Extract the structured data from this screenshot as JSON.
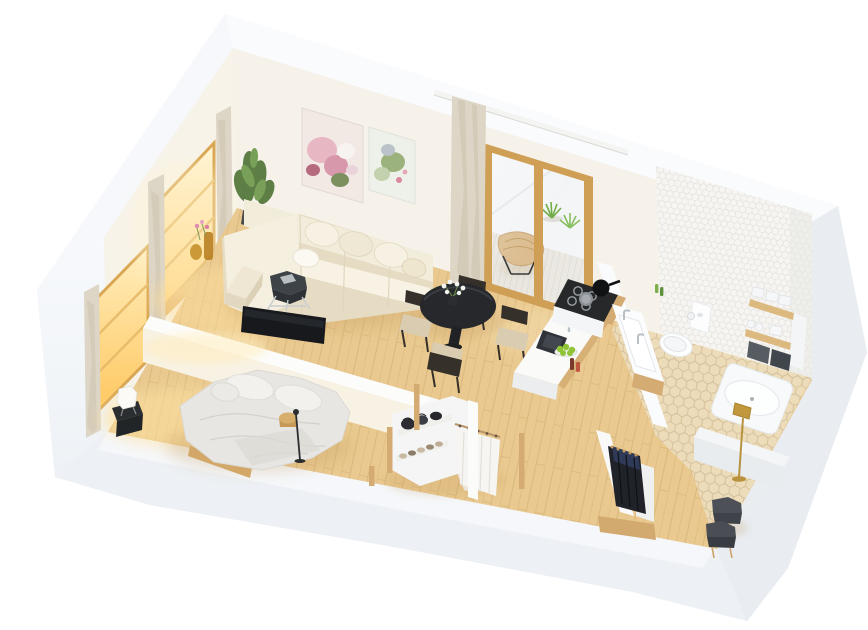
{
  "meta": {
    "kind": "isometric-3d-floorplan-render",
    "text_visible": false
  },
  "palette": {
    "bg": "#ffffff",
    "band_top": "#fafbfd",
    "band_left": "#f6f8fb",
    "band_right": "#e9edf2",
    "band_bottom": "#edf0f4",
    "band_bottom_top_face": "#f5f7fa",
    "wall_inner_warm": "#f7f3e9",
    "wall_inner_right": "#eaedf0",
    "left_outer_face": "#f3f6f9",
    "floor_wood": "#e9c98f",
    "floor_glow": "#ffdf9e",
    "hex_floor": "#ecdcba",
    "hex_floor_line": "#c9b188",
    "hex_wall": "#f6f5f2",
    "deck": "#e8e5de",
    "door_wood": "#cf9f56",
    "window_frame": "#dfae5c",
    "sill_wood": "#dfb26a",
    "curtain": "#ddd5c5",
    "sofa_cream": "#f2ecdb",
    "sofa_light": "#f7f2e4",
    "sofa_shadow": "#e6dcc4",
    "pouf": "#efe7d3",
    "plant_green": "#5d7f46",
    "plant_light": "#78a058",
    "grass_green": "#69a83c",
    "graphite": "#3e4347",
    "tv_black": "#17191c",
    "chair_frame": "#35302a",
    "chair_seat": "#d9ccb0",
    "table_black": "#26282b",
    "wood_oak": "#d4ab72",
    "amber": "#c8922f",
    "counter_white": "#fafaf8",
    "counter_face": "#ebedee",
    "sink_dark": "#30343a",
    "steel": "#b9c0c6",
    "apple_green": "#8fc437",
    "fixture_white": "#fbfcfd",
    "toilet_white": "#fdfefe",
    "towel_white": "#f6f7f8",
    "basket_gray": "#575c63",
    "basket_dark": "#41464d",
    "tub_white": "#f7f9fa",
    "brass": "#c2983f",
    "bedding": "#e8e6e2",
    "pillow_white": "#f2f1ee",
    "bed_wood": "#d2a768",
    "nightstand_black": "#2b2e31",
    "lamp_white": "#fbfaf6",
    "clothes_white": "#f6f5f2",
    "clothes_dark": "#20232a",
    "clothes_navy": "#2e3a57",
    "stool_gray": "#4d5157",
    "stool_dark": "#393d43",
    "shadow_warm": "#c29a5e",
    "painting1_bg": "#f2e8e4",
    "painting2_bg": "#eef1e9",
    "rod_white": "#f4f4f2",
    "divider_face": "#f8f2e4",
    "partition_white": "#f7f9fa"
  },
  "scene": {
    "rooms": [
      {
        "name": "living-room",
        "items": [
          "corner-sofa",
          "throw-pillows",
          "pouf",
          "graphite-side-table",
          "tv",
          "floral-wall-art",
          "green-wall-art",
          "potted-plant",
          "amber-vases",
          "curtains",
          "glowing-windows"
        ]
      },
      {
        "name": "dining-area",
        "items": [
          "round-black-table",
          "black-chair-left",
          "black-chair-top",
          "black-chair-right",
          "black-chair-bottom",
          "white-flowers"
        ]
      },
      {
        "name": "kitchen",
        "items": [
          "gas-cooktop",
          "pans",
          "island-counter",
          "dark-sink",
          "faucet",
          "green-apples",
          "bottles"
        ]
      },
      {
        "name": "balcony",
        "items": [
          "sliding-glass-door",
          "butterfly-chair",
          "grass-plants",
          "plank-deck",
          "curtain-rod"
        ]
      },
      {
        "name": "bathroom",
        "items": [
          "vanity-sink",
          "wall-hung-toilet",
          "flush-panel",
          "toilet-paper-roll",
          "wood-shelves",
          "white-towels",
          "gray-baskets",
          "bathtub",
          "brass-floor-lamp",
          "hex-tile-wall",
          "hex-tile-floor",
          "green-bottles"
        ]
      },
      {
        "name": "bedroom",
        "items": [
          "double-bed",
          "pillows",
          "wood-side-stool",
          "black-floor-lamp",
          "black-nightstand",
          "white-table-lamp",
          "glowing-window",
          "curtains"
        ]
      },
      {
        "name": "walk-in-closet",
        "items": [
          "open-shelf-unit",
          "dark-bags",
          "shoes",
          "white-hanging-clothes",
          "oak-posts"
        ]
      },
      {
        "name": "hall-closet",
        "items": [
          "dark-hanging-clothes",
          "white-panels",
          "oak-plinth"
        ]
      },
      {
        "name": "hallway",
        "items": [
          "gray-stool-1",
          "gray-stool-2"
        ]
      }
    ]
  }
}
